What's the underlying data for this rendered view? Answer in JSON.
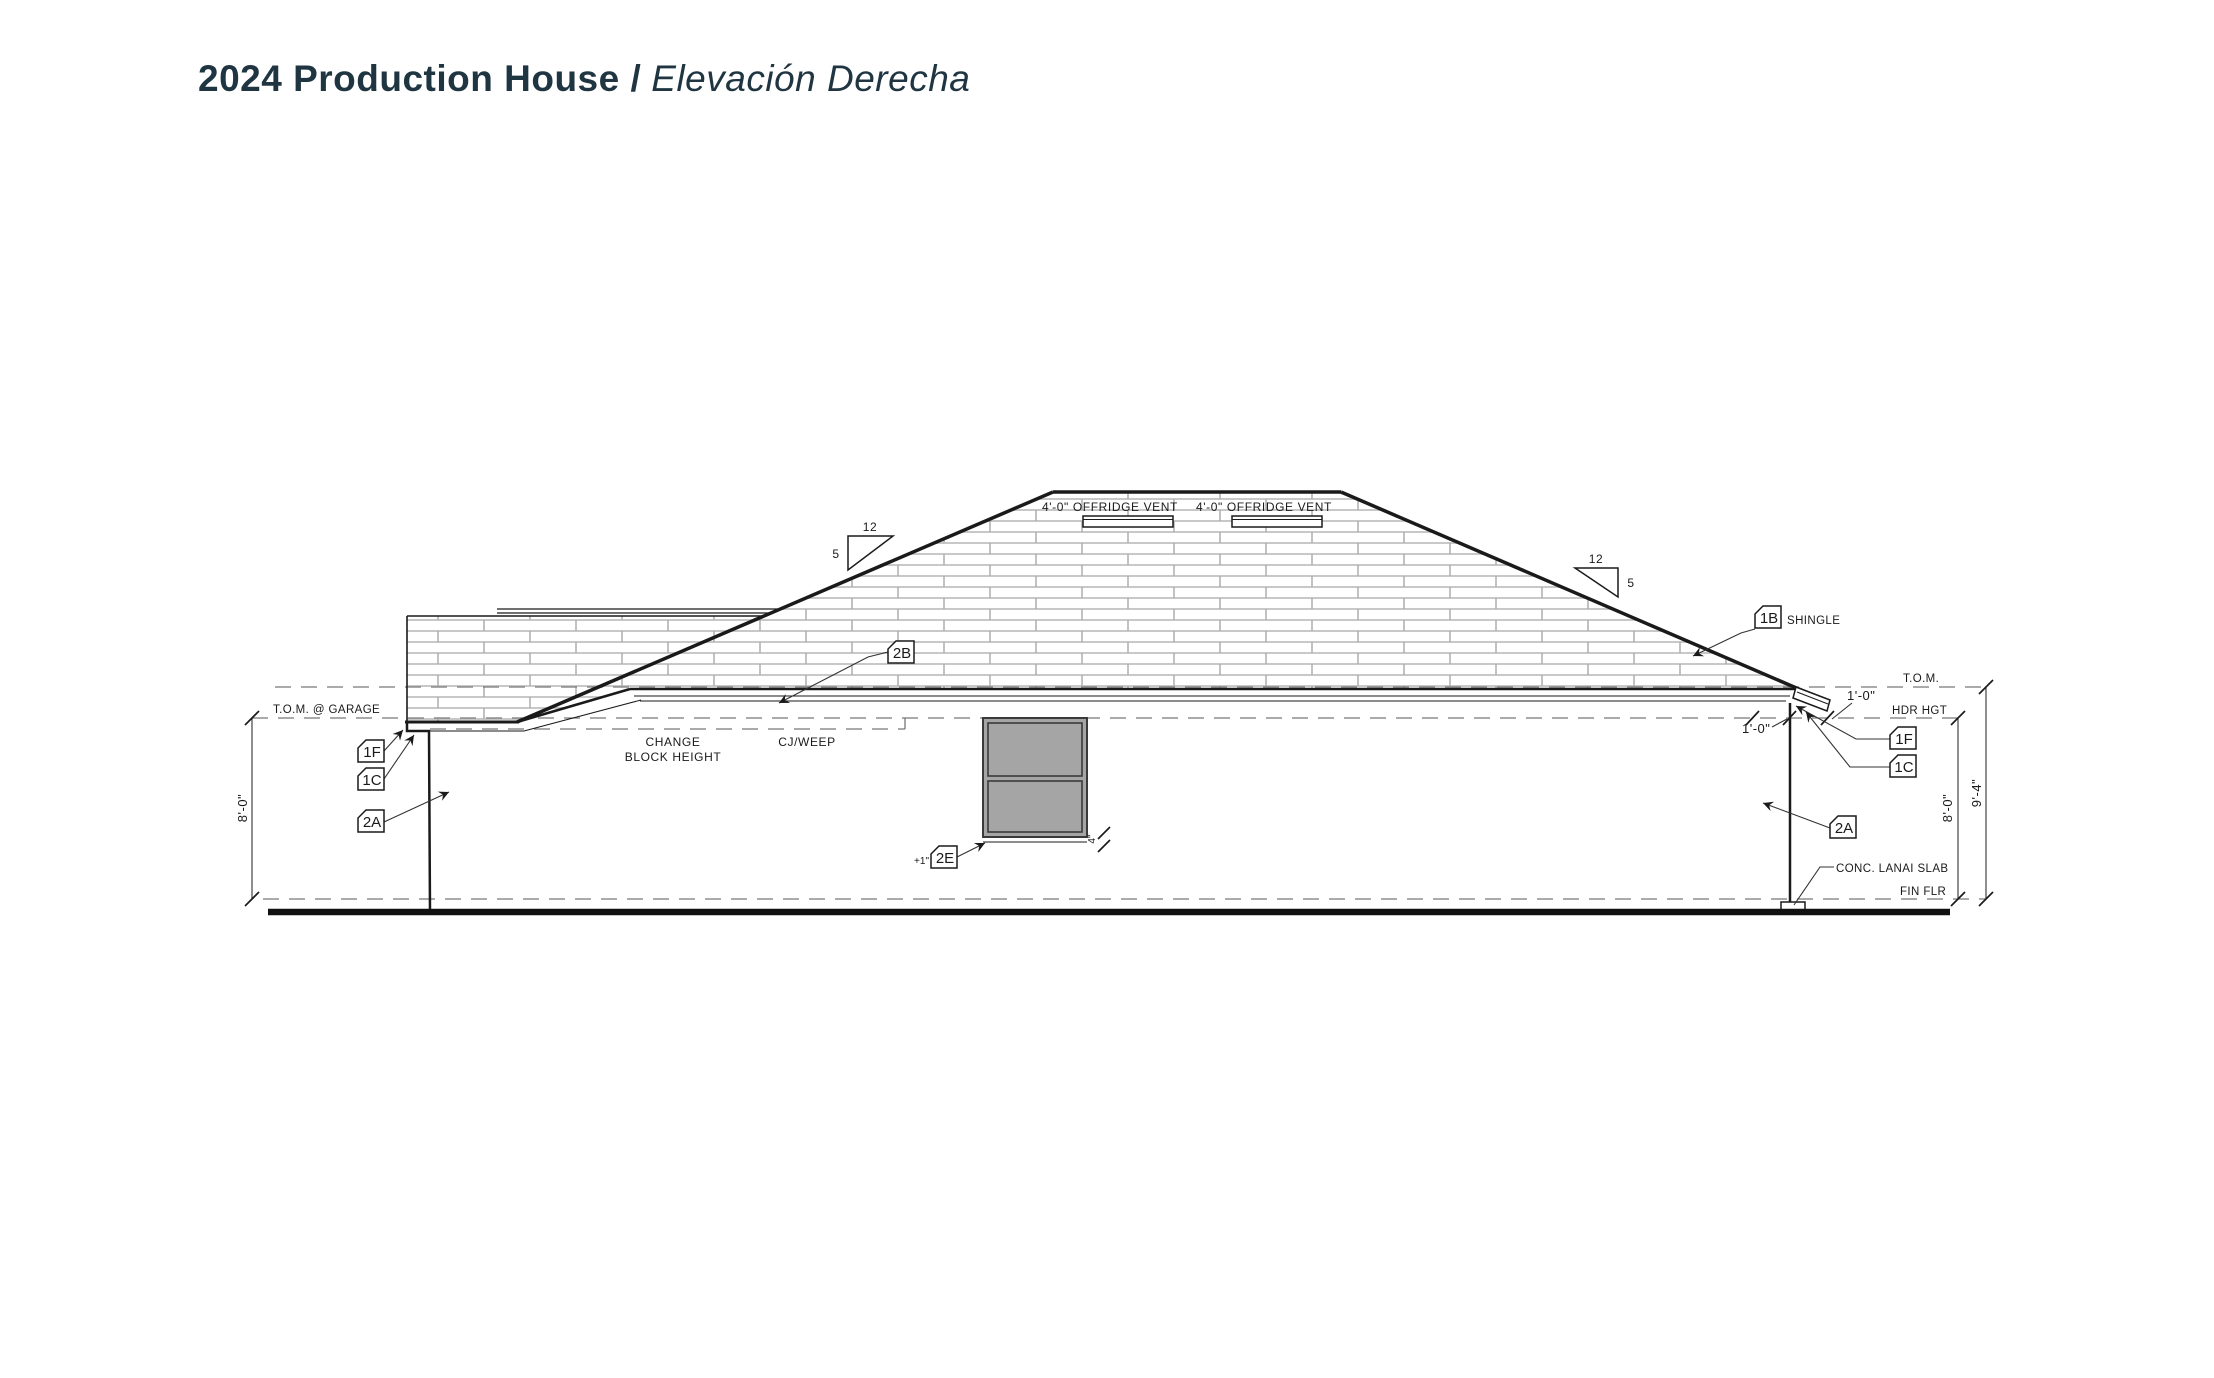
{
  "title": {
    "project": "2024 Production House /",
    "sheet": "Elevación Derecha"
  },
  "levels": {
    "tom": "T.O.M.",
    "tom_garage": "T.O.M. @ GARAGE",
    "hdr": "HDR HGT",
    "fin_flr": "FIN FLR"
  },
  "roof": {
    "vent_label": "4'-0\" OFFRIDGE VENT",
    "shingle_note": "SHINGLE",
    "pitch": {
      "run": "12",
      "rise": "5"
    }
  },
  "keynotes": {
    "shingle": "1B",
    "fascia": "2B",
    "f1": "1F",
    "c1": "1C",
    "a2": "2A",
    "e2": "2E"
  },
  "dims": {
    "wall_height": "8'-0\"",
    "total_height": "9'-4\"",
    "overhang": "1'-0\"",
    "sill": "4\"",
    "plus_one": "+1\""
  },
  "notes": {
    "change_line1": "CHANGE",
    "change_line2": "BLOCK HEIGHT",
    "cj_weep": "CJ/WEEP",
    "conc_lanai": "CONC. LANAI SLAB"
  },
  "colors": {
    "line": "#1a1a1a",
    "dash": "#777777",
    "hatch": "#c8c8c8",
    "window_fill": "#a5a5a5",
    "title": "#1f3541",
    "background": "#ffffff"
  }
}
